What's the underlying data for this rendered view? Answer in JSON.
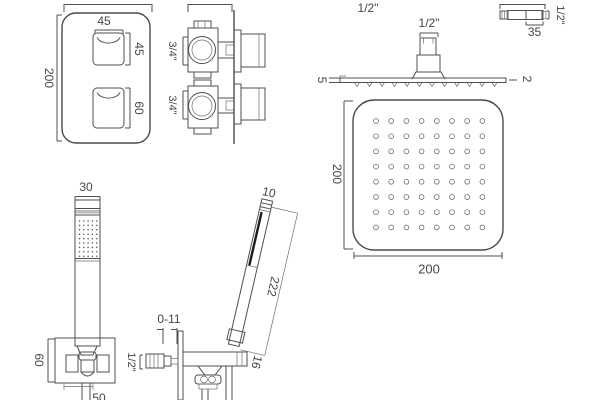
{
  "drawing": {
    "valve_front": {
      "height_label": "200",
      "button_width_label": "45",
      "upper_button_height_label": "45",
      "lower_button_height_label": "60"
    },
    "valve_side": {
      "upper_port_label": "3/4\"",
      "lower_port_label": "3/4\""
    },
    "head_side": {
      "inlet_label": "1/2\"",
      "connector_label": "1/2\"",
      "plate_edge_left_label": "5",
      "plate_edge_right_label": "2"
    },
    "wall_union": {
      "length_label": "35",
      "thread_label": "1/2\""
    },
    "head_bottom": {
      "side_label_left": "200",
      "side_label_bottom": "200",
      "nozzle_rows": 8,
      "nozzle_cols": 8
    },
    "handset_front": {
      "width_label": "30",
      "bracket_height_label": "60",
      "bottom_label": "50",
      "spray_rows": 9,
      "spray_cols": 5
    },
    "handset_side": {
      "head_width_label": "10",
      "length_label": "222",
      "adjustment_label": "0-11",
      "outlet_label": "1/2\"",
      "socket_label": "16"
    }
  }
}
